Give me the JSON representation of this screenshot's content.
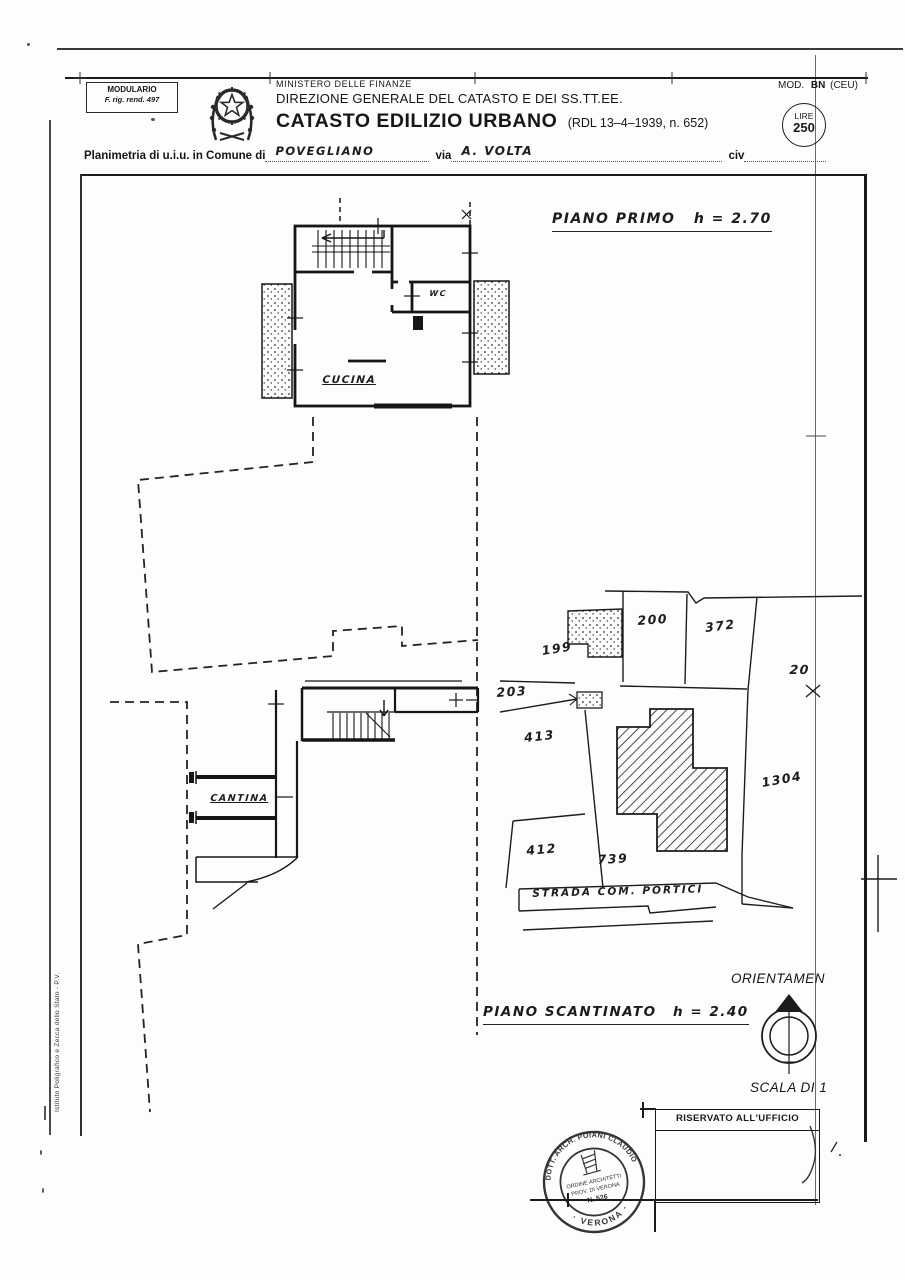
{
  "header": {
    "modulario_line1": "MODULARIO",
    "modulario_line2": "F. rig. rend. 497",
    "ministero": "MINISTERO DELLE FINANZE",
    "direzione": "DIREZIONE GENERALE DEL CATASTO E DEI SS.TT.EE.",
    "titolo": "CATASTO EDILIZIO URBANO",
    "titolo_rif": "(RDL 13–4–1939, n. 652)",
    "mod_label": "MOD.",
    "mod_code": "BN",
    "mod_ceu": "(CEU)",
    "lire_label": "LIRE",
    "lire_value": "250"
  },
  "subject": {
    "prefix": "Planimetria di u.i.u. in Comune di",
    "comune": "POVEGLIANO",
    "via_label": "via",
    "via_value": "A. VOLTA",
    "civ_label": "civ"
  },
  "captions": {
    "first_floor": "PIANO PRIMO",
    "first_floor_height": "h = 2.70",
    "basement": "PIANO SCANTINATO",
    "basement_height": "h = 2.40"
  },
  "rooms": {
    "cucina": "CUCINA",
    "wc": "WC",
    "cantina": "CANTINA"
  },
  "site": {
    "p199": "199",
    "p200": "200",
    "p372": "372",
    "p203": "203",
    "p413": "413",
    "p1304": "1304",
    "p412": "412",
    "p739": "739",
    "edge_number": "20",
    "road": "STRADA  COM.  PORTICI"
  },
  "footer": {
    "orientation": "ORIENTAMEN",
    "scale": "SCALA DI 1",
    "office": "RISERVATO ALL'UFFICIO",
    "credit": "Istituto Poligrafico e Zecca dello Stato - P.V."
  },
  "stamp": {
    "arc_top": "DOTT. ARCH. POIANI CLAUDIO",
    "arc_bottom": "· VERONA ·",
    "line1": "ORDINE ARCHITETTI",
    "line2": "PROV. DI VERONA",
    "line3": "N. 526"
  }
}
